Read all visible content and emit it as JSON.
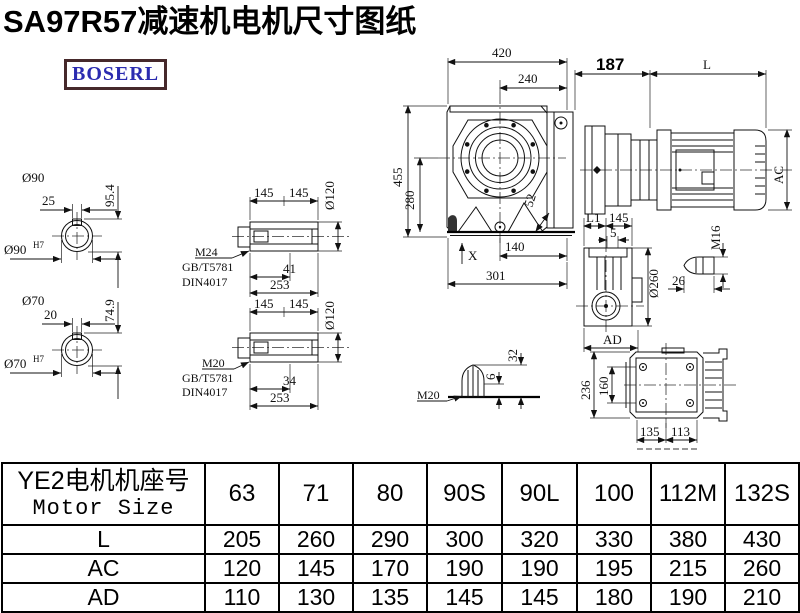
{
  "title": "SA97R57减速机电机尺寸图纸",
  "logo": "BOSERL",
  "drawing": {
    "shaft_top": {
      "dia": "Ø90",
      "key_w": "25",
      "height": "95.4",
      "bore": "Ø90",
      "tol": "H7"
    },
    "shaft_bottom": {
      "dia": "Ø70",
      "key_w": "20",
      "height": "74.9",
      "bore": "Ø70",
      "tol": "H7"
    },
    "hollow_top": {
      "seg1": "145",
      "seg2": "145",
      "dia": "Ø120",
      "thread": "M24",
      "std1": "GB/T5781",
      "std2": "DIN4017",
      "len_in": "41",
      "len_total": "253"
    },
    "hollow_bottom": {
      "seg1": "145",
      "seg2": "145",
      "dia": "Ø120",
      "thread": "M20",
      "std1": "GB/T5781",
      "std2": "DIN4017",
      "len_in": "34",
      "len_total": "253"
    },
    "front": {
      "width": "420",
      "width2": "240",
      "height": "455",
      "height2": "280",
      "dim52": "52",
      "x_mark": "X",
      "bottom1": "140",
      "bottom2": "301"
    },
    "motor": {
      "dim187": "187",
      "len": "L",
      "ac": "AC"
    },
    "side": {
      "l1": "L1",
      "seg": "145",
      "dim5": "5",
      "dia": "Ø260",
      "ad": "AD",
      "m16": "M16",
      "dim26": "26"
    },
    "plug": {
      "thread": "M20",
      "dim6": "6",
      "dim32": "32"
    },
    "rear": {
      "h_out": "236",
      "h_in": "160",
      "w1": "135",
      "w2": "113"
    }
  },
  "table": {
    "header_cn": "YE2电机机座号",
    "header_en": "Motor Size",
    "sizes": [
      "63",
      "71",
      "80",
      "90S",
      "90L",
      "100",
      "112M",
      "132S"
    ],
    "rows": [
      {
        "label": "L",
        "values": [
          "205",
          "260",
          "290",
          "300",
          "320",
          "330",
          "380",
          "430"
        ]
      },
      {
        "label": "AC",
        "values": [
          "120",
          "145",
          "170",
          "190",
          "190",
          "195",
          "215",
          "260"
        ]
      },
      {
        "label": "AD",
        "values": [
          "110",
          "130",
          "135",
          "145",
          "145",
          "180",
          "190",
          "210"
        ]
      }
    ]
  }
}
